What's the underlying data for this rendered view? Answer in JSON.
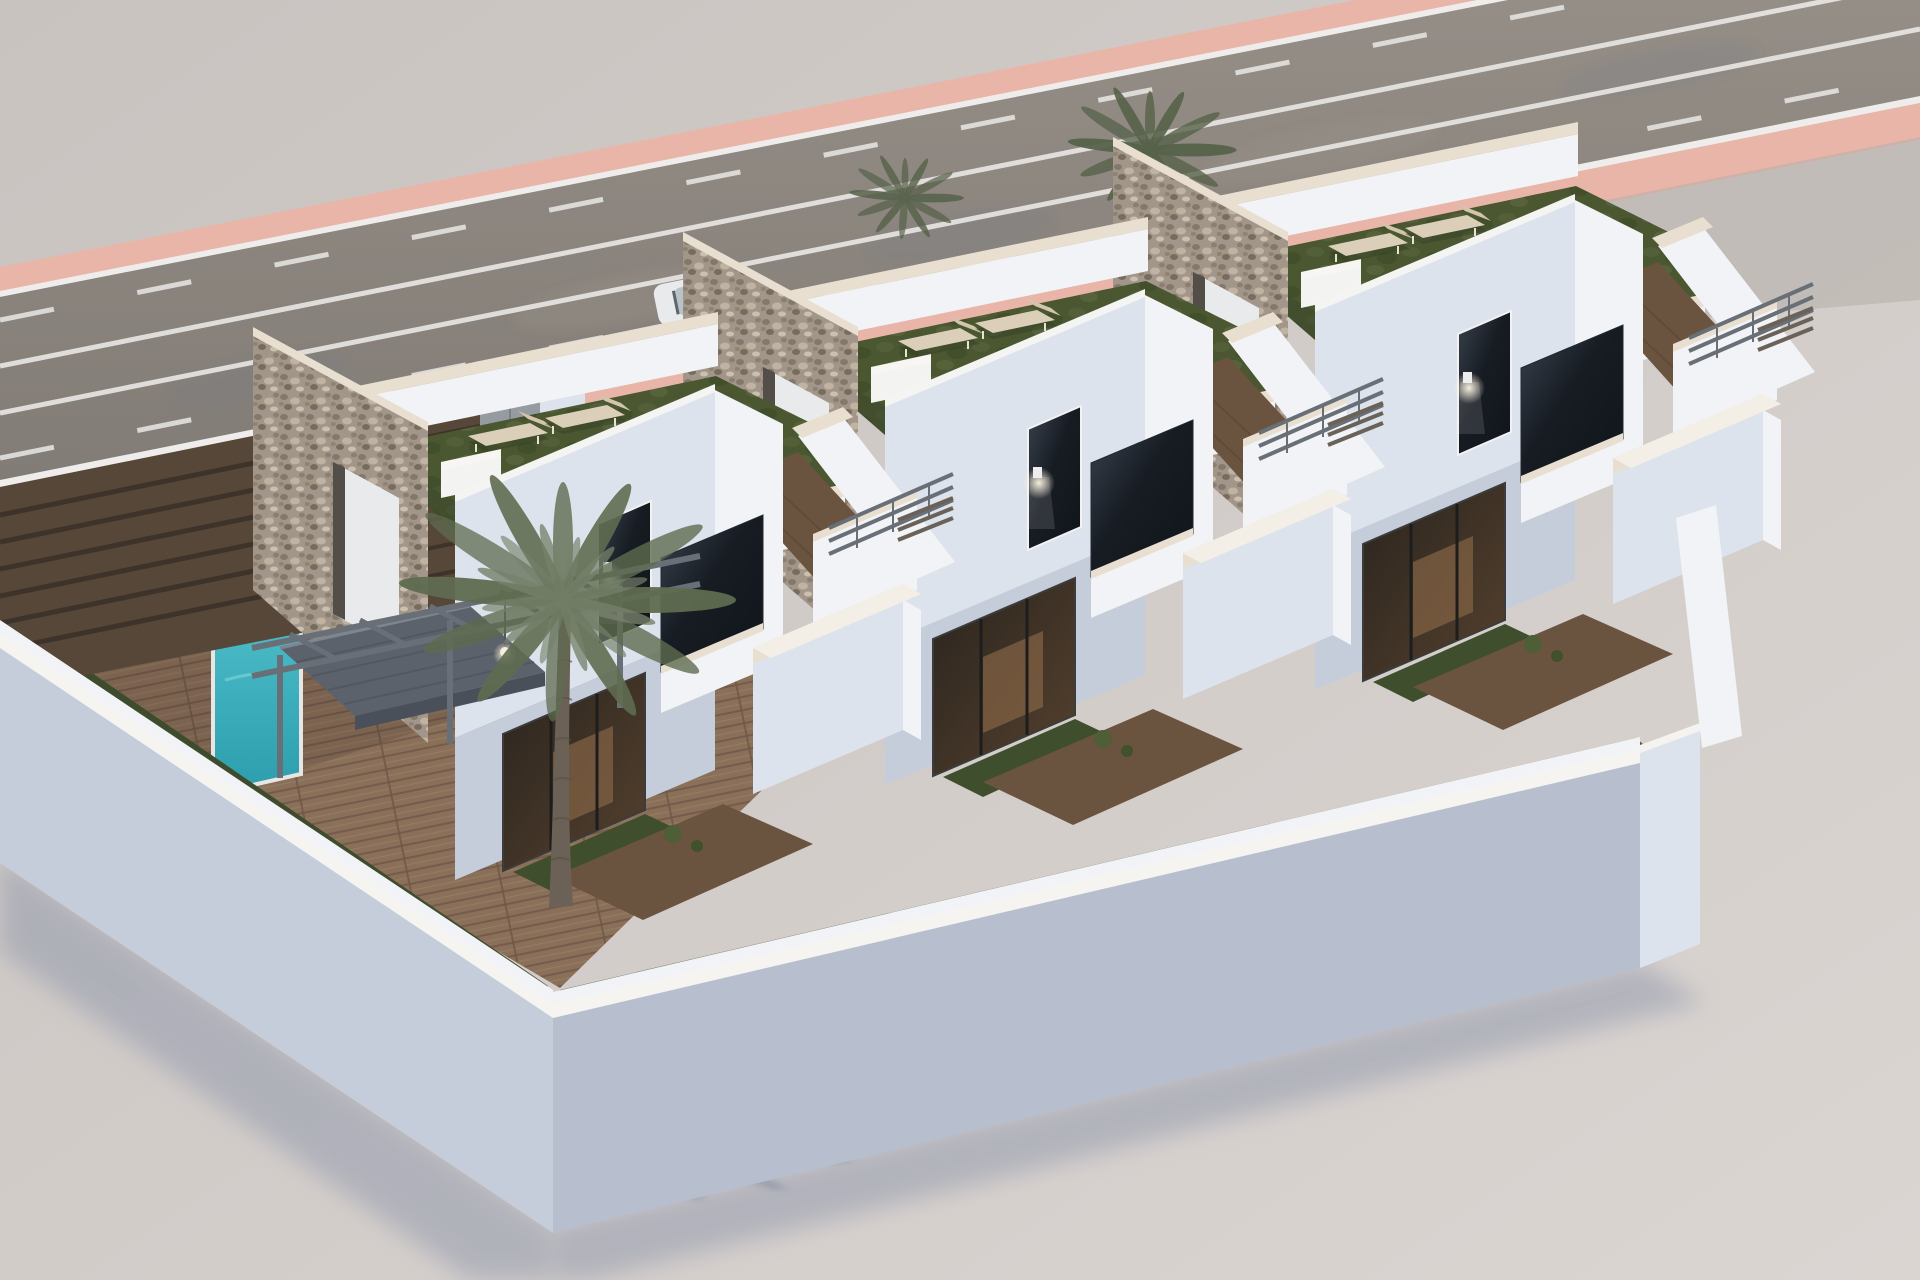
{
  "scene": {
    "description": "Photorealistic CGI aerial rendering of a residential development: three modern white two-storey townhouses in a row, each with a rooftop artificial-grass terrace, two sun loungers, rustic stone party walls, first-floor wood-deck terraces, dark glazed windows and balconies, lit wall lamps, private front courtyards with grass and timber decking, one small swimming pool, a large palm tree, a slatted brown entrance gate, a white perimeter wall casting a long shadow, and a gray asphalt road with salmon-pink sidewalks and white lane markings running behind the plot",
    "house_count": 3,
    "loungers_per_roof": 2,
    "rooftop_planters_per_roof": 2,
    "palm_trees": {
      "large_foreground": 1,
      "small_background": 2
    },
    "swimming_pools": 1,
    "wall_lamps_lit": true,
    "time_of_day": "dusk with long shadows"
  },
  "road": {
    "orientation": "diagonal, upper-left to upper-right",
    "lane_markings": [
      "dashed",
      "solid",
      "solid",
      "dashed"
    ],
    "sidewalk_color_name": "salmon pink",
    "curb_color_name": "white",
    "parked_vehicles": 1
  },
  "houses": [
    {
      "id": "house-3",
      "tx": 1113,
      "ty": 142
    },
    {
      "id": "house-2",
      "tx": 683,
      "ty": 237
    },
    {
      "id": "house-1",
      "tx": 253,
      "ty": 332
    }
  ],
  "palette": {
    "ground_a": "#c9c3c0",
    "ground_b": "#dbd5d2",
    "shadow": "#8e97ab",
    "road_a": "#958e87",
    "road_b": "#827c76",
    "road_blue": "#747a88",
    "road_tan": "#a59c90",
    "pink": "#e9b5a9",
    "curb": "#efedeb",
    "lane": "#e9e7e4",
    "stone": "#a2958a",
    "stone_dark": "#7d7062",
    "stone_light": "#c3b6a4",
    "coping": "#e9dfd0",
    "wall_lit": "#f1f3f6",
    "wall_mid": "#dde3ec",
    "wall_shade": "#c6cdda",
    "wall_deep": "#b7bfcf",
    "glass_a": "#171c23",
    "glass_b": "#3a434f",
    "grass_a": "#4a5731",
    "grass_b": "#55633a",
    "grass_dark": "#3f4e2c",
    "deck": "#8a7058",
    "deck_dark": "#6b543f",
    "pool_a": "#54c3cf",
    "pool_b": "#2b9dac",
    "fence": "#564738",
    "fence_dark": "#3d332a",
    "gate": "#959ba1",
    "pergola": "#696f76",
    "canopy": "#5b626c",
    "canopy_dark": "#49505a",
    "palm": "#5f6b50",
    "palm_bg": "#566249",
    "palm_shadow": "#7b8599",
    "trunk": "#6b6156",
    "lounger": "#dbcfb9",
    "hedge": "#3e4c2d",
    "interior_warm": "#8a6848",
    "glow": "#fff6e0"
  }
}
